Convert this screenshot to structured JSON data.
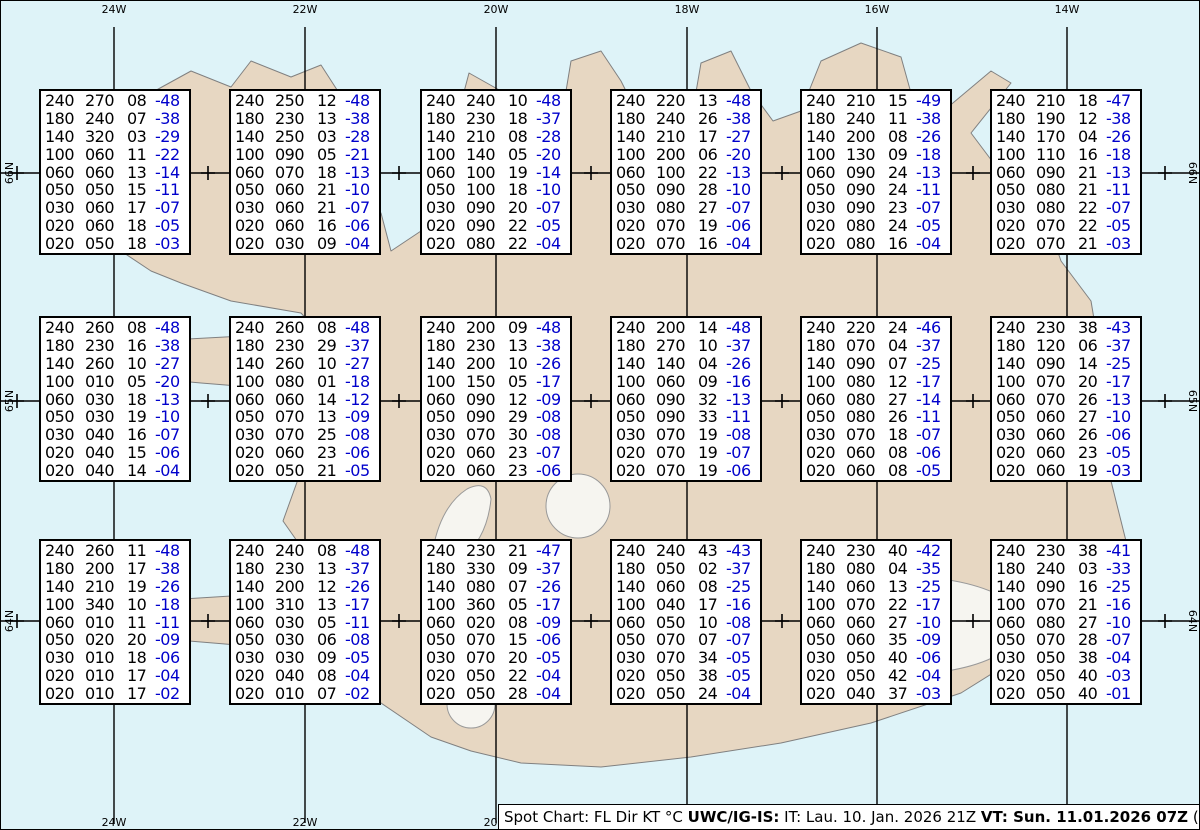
{
  "graticule": {
    "top_labels": [
      "24W",
      "22W",
      "20W",
      "18W",
      "16W",
      "14W"
    ],
    "bottom_labels": [
      "24W",
      "22W",
      "20W",
      "18W",
      "16W",
      "14W"
    ],
    "left_labels": [
      "66N",
      "65N",
      "64N"
    ],
    "right_labels": [
      "66N",
      "65N",
      "64N"
    ]
  },
  "legend_columns": "FL Dir KT °C",
  "spot_boxes": [
    {
      "rows": [
        [
          "240",
          "270",
          "08",
          "-48"
        ],
        [
          "180",
          "240",
          "07",
          "-38"
        ],
        [
          "140",
          "320",
          "03",
          "-29"
        ],
        [
          "100",
          "060",
          "11",
          "-22"
        ],
        [
          "060",
          "060",
          "13",
          "-14"
        ],
        [
          "050",
          "050",
          "15",
          "-11"
        ],
        [
          "030",
          "060",
          "17",
          "-07"
        ],
        [
          "020",
          "060",
          "18",
          "-05"
        ],
        [
          "020",
          "050",
          "18",
          "-03"
        ]
      ]
    },
    {
      "rows": [
        [
          "240",
          "250",
          "12",
          "-48"
        ],
        [
          "180",
          "230",
          "13",
          "-38"
        ],
        [
          "140",
          "250",
          "03",
          "-28"
        ],
        [
          "100",
          "090",
          "05",
          "-21"
        ],
        [
          "060",
          "070",
          "18",
          "-13"
        ],
        [
          "050",
          "060",
          "21",
          "-10"
        ],
        [
          "030",
          "060",
          "21",
          "-07"
        ],
        [
          "020",
          "060",
          "16",
          "-06"
        ],
        [
          "020",
          "030",
          "09",
          "-04"
        ]
      ]
    },
    {
      "rows": [
        [
          "240",
          "240",
          "10",
          "-48"
        ],
        [
          "180",
          "230",
          "18",
          "-37"
        ],
        [
          "140",
          "210",
          "08",
          "-28"
        ],
        [
          "100",
          "140",
          "05",
          "-20"
        ],
        [
          "060",
          "100",
          "19",
          "-14"
        ],
        [
          "050",
          "100",
          "18",
          "-10"
        ],
        [
          "030",
          "090",
          "20",
          "-07"
        ],
        [
          "020",
          "090",
          "22",
          "-05"
        ],
        [
          "020",
          "080",
          "22",
          "-04"
        ]
      ]
    },
    {
      "rows": [
        [
          "240",
          "220",
          "13",
          "-48"
        ],
        [
          "180",
          "240",
          "26",
          "-38"
        ],
        [
          "140",
          "210",
          "17",
          "-27"
        ],
        [
          "100",
          "200",
          "06",
          "-20"
        ],
        [
          "060",
          "100",
          "22",
          "-13"
        ],
        [
          "050",
          "090",
          "28",
          "-10"
        ],
        [
          "030",
          "080",
          "27",
          "-07"
        ],
        [
          "020",
          "070",
          "19",
          "-06"
        ],
        [
          "020",
          "070",
          "16",
          "-04"
        ]
      ]
    },
    {
      "rows": [
        [
          "240",
          "210",
          "15",
          "-49"
        ],
        [
          "180",
          "240",
          "11",
          "-38"
        ],
        [
          "140",
          "200",
          "08",
          "-26"
        ],
        [
          "100",
          "130",
          "09",
          "-18"
        ],
        [
          "060",
          "090",
          "24",
          "-13"
        ],
        [
          "050",
          "090",
          "24",
          "-11"
        ],
        [
          "030",
          "090",
          "23",
          "-07"
        ],
        [
          "020",
          "080",
          "24",
          "-05"
        ],
        [
          "020",
          "080",
          "16",
          "-04"
        ]
      ]
    },
    {
      "rows": [
        [
          "240",
          "210",
          "18",
          "-47"
        ],
        [
          "180",
          "190",
          "12",
          "-38"
        ],
        [
          "140",
          "170",
          "04",
          "-26"
        ],
        [
          "100",
          "110",
          "16",
          "-18"
        ],
        [
          "060",
          "090",
          "21",
          "-13"
        ],
        [
          "050",
          "080",
          "21",
          "-11"
        ],
        [
          "030",
          "080",
          "22",
          "-07"
        ],
        [
          "020",
          "070",
          "22",
          "-05"
        ],
        [
          "020",
          "070",
          "21",
          "-03"
        ]
      ]
    },
    {
      "rows": [
        [
          "240",
          "260",
          "08",
          "-48"
        ],
        [
          "180",
          "230",
          "16",
          "-38"
        ],
        [
          "140",
          "260",
          "10",
          "-27"
        ],
        [
          "100",
          "010",
          "05",
          "-20"
        ],
        [
          "060",
          "030",
          "18",
          "-13"
        ],
        [
          "050",
          "030",
          "19",
          "-10"
        ],
        [
          "030",
          "040",
          "16",
          "-07"
        ],
        [
          "020",
          "040",
          "15",
          "-06"
        ],
        [
          "020",
          "040",
          "14",
          "-04"
        ]
      ]
    },
    {
      "rows": [
        [
          "240",
          "260",
          "08",
          "-48"
        ],
        [
          "180",
          "230",
          "29",
          "-37"
        ],
        [
          "140",
          "260",
          "10",
          "-27"
        ],
        [
          "100",
          "080",
          "01",
          "-18"
        ],
        [
          "060",
          "060",
          "14",
          "-12"
        ],
        [
          "050",
          "070",
          "13",
          "-09"
        ],
        [
          "030",
          "070",
          "25",
          "-08"
        ],
        [
          "020",
          "060",
          "23",
          "-06"
        ],
        [
          "020",
          "050",
          "21",
          "-05"
        ]
      ]
    },
    {
      "rows": [
        [
          "240",
          "200",
          "09",
          "-48"
        ],
        [
          "180",
          "230",
          "13",
          "-38"
        ],
        [
          "140",
          "200",
          "10",
          "-26"
        ],
        [
          "100",
          "150",
          "05",
          "-17"
        ],
        [
          "060",
          "090",
          "12",
          "-09"
        ],
        [
          "050",
          "090",
          "29",
          "-08"
        ],
        [
          "030",
          "070",
          "30",
          "-08"
        ],
        [
          "020",
          "060",
          "23",
          "-07"
        ],
        [
          "020",
          "060",
          "23",
          "-06"
        ]
      ]
    },
    {
      "rows": [
        [
          "240",
          "200",
          "14",
          "-48"
        ],
        [
          "180",
          "270",
          "10",
          "-37"
        ],
        [
          "140",
          "140",
          "04",
          "-26"
        ],
        [
          "100",
          "060",
          "09",
          "-16"
        ],
        [
          "060",
          "090",
          "32",
          "-13"
        ],
        [
          "050",
          "090",
          "33",
          "-11"
        ],
        [
          "030",
          "070",
          "19",
          "-08"
        ],
        [
          "020",
          "070",
          "19",
          "-07"
        ],
        [
          "020",
          "070",
          "19",
          "-06"
        ]
      ]
    },
    {
      "rows": [
        [
          "240",
          "220",
          "24",
          "-46"
        ],
        [
          "180",
          "070",
          "04",
          "-37"
        ],
        [
          "140",
          "090",
          "07",
          "-25"
        ],
        [
          "100",
          "080",
          "12",
          "-17"
        ],
        [
          "060",
          "080",
          "27",
          "-14"
        ],
        [
          "050",
          "080",
          "26",
          "-11"
        ],
        [
          "030",
          "070",
          "18",
          "-07"
        ],
        [
          "020",
          "060",
          "08",
          "-06"
        ],
        [
          "020",
          "060",
          "08",
          "-05"
        ]
      ]
    },
    {
      "rows": [
        [
          "240",
          "230",
          "38",
          "-43"
        ],
        [
          "180",
          "120",
          "06",
          "-37"
        ],
        [
          "140",
          "090",
          "14",
          "-25"
        ],
        [
          "100",
          "070",
          "20",
          "-17"
        ],
        [
          "060",
          "070",
          "26",
          "-13"
        ],
        [
          "050",
          "060",
          "27",
          "-10"
        ],
        [
          "030",
          "060",
          "26",
          "-06"
        ],
        [
          "020",
          "060",
          "23",
          "-05"
        ],
        [
          "020",
          "060",
          "19",
          "-03"
        ]
      ]
    },
    {
      "rows": [
        [
          "240",
          "260",
          "11",
          "-48"
        ],
        [
          "180",
          "200",
          "17",
          "-38"
        ],
        [
          "140",
          "210",
          "19",
          "-26"
        ],
        [
          "100",
          "340",
          "10",
          "-18"
        ],
        [
          "060",
          "010",
          "11",
          "-11"
        ],
        [
          "050",
          "020",
          "20",
          "-09"
        ],
        [
          "030",
          "010",
          "18",
          "-06"
        ],
        [
          "020",
          "010",
          "17",
          "-04"
        ],
        [
          "020",
          "010",
          "17",
          "-02"
        ]
      ]
    },
    {
      "rows": [
        [
          "240",
          "240",
          "08",
          "-48"
        ],
        [
          "180",
          "230",
          "13",
          "-37"
        ],
        [
          "140",
          "200",
          "12",
          "-26"
        ],
        [
          "100",
          "310",
          "13",
          "-17"
        ],
        [
          "060",
          "030",
          "05",
          "-11"
        ],
        [
          "050",
          "030",
          "06",
          "-08"
        ],
        [
          "030",
          "030",
          "09",
          "-05"
        ],
        [
          "020",
          "040",
          "08",
          "-04"
        ],
        [
          "020",
          "010",
          "07",
          "-02"
        ]
      ]
    },
    {
      "rows": [
        [
          "240",
          "230",
          "21",
          "-47"
        ],
        [
          "180",
          "330",
          "09",
          "-37"
        ],
        [
          "140",
          "080",
          "07",
          "-26"
        ],
        [
          "100",
          "360",
          "05",
          "-17"
        ],
        [
          "060",
          "020",
          "08",
          "-09"
        ],
        [
          "050",
          "070",
          "15",
          "-06"
        ],
        [
          "030",
          "070",
          "20",
          "-05"
        ],
        [
          "020",
          "050",
          "22",
          "-04"
        ],
        [
          "020",
          "050",
          "28",
          "-04"
        ]
      ]
    },
    {
      "rows": [
        [
          "240",
          "240",
          "43",
          "-43"
        ],
        [
          "180",
          "050",
          "02",
          "-37"
        ],
        [
          "140",
          "060",
          "08",
          "-25"
        ],
        [
          "100",
          "040",
          "17",
          "-16"
        ],
        [
          "060",
          "050",
          "10",
          "-08"
        ],
        [
          "050",
          "070",
          "07",
          "-07"
        ],
        [
          "030",
          "070",
          "34",
          "-05"
        ],
        [
          "020",
          "050",
          "38",
          "-05"
        ],
        [
          "020",
          "050",
          "24",
          "-04"
        ]
      ]
    },
    {
      "rows": [
        [
          "240",
          "230",
          "40",
          "-42"
        ],
        [
          "180",
          "080",
          "04",
          "-35"
        ],
        [
          "140",
          "060",
          "13",
          "-25"
        ],
        [
          "100",
          "070",
          "22",
          "-17"
        ],
        [
          "060",
          "060",
          "27",
          "-10"
        ],
        [
          "050",
          "060",
          "35",
          "-09"
        ],
        [
          "030",
          "050",
          "40",
          "-06"
        ],
        [
          "020",
          "050",
          "42",
          "-04"
        ],
        [
          "020",
          "040",
          "37",
          "-03"
        ]
      ]
    },
    {
      "rows": [
        [
          "240",
          "230",
          "38",
          "-41"
        ],
        [
          "180",
          "240",
          "03",
          "-33"
        ],
        [
          "140",
          "090",
          "16",
          "-25"
        ],
        [
          "100",
          "070",
          "21",
          "-16"
        ],
        [
          "060",
          "080",
          "27",
          "-10"
        ],
        [
          "050",
          "070",
          "28",
          "-07"
        ],
        [
          "030",
          "050",
          "38",
          "-04"
        ],
        [
          "020",
          "050",
          "40",
          "-03"
        ],
        [
          "020",
          "050",
          "40",
          "-01"
        ]
      ]
    }
  ],
  "caption": {
    "part1": "Spot Chart: FL Dir KT °C ",
    "part2": "UWC/IG-IS:",
    "part3": " IT: Lau. 10. Jan. 2026 21Z ",
    "part4": "VT: Sun. 11.01.2026 07Z",
    "part5": " (+10 h)"
  },
  "colors": {
    "ocean": "#def3f8",
    "land": "#e7d7c2",
    "coastline": "#808080",
    "glacier": "#f6f5f0",
    "grid": "#000000",
    "temp_text": "#0000cc",
    "box_background": "#ffffff"
  }
}
